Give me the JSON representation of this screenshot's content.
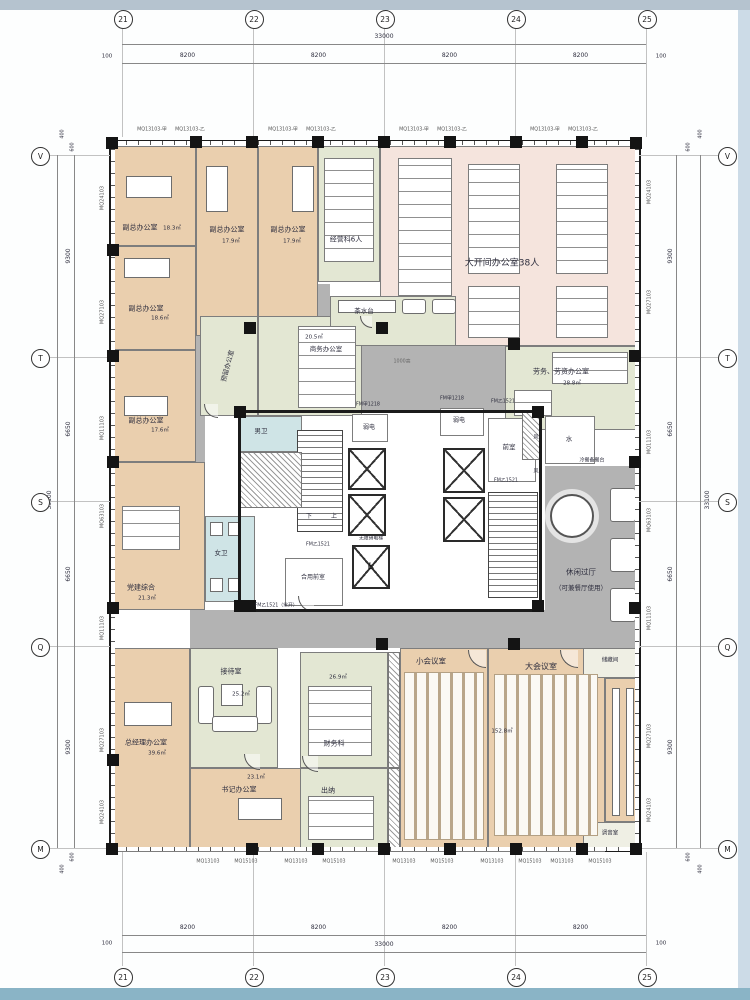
{
  "drawing": {
    "grid": {
      "cols": [
        "21",
        "22",
        "23",
        "24",
        "25"
      ],
      "rows": [
        "V",
        "T",
        "S",
        "Q",
        "M"
      ],
      "bay_width": "8200",
      "total_width": "33000",
      "edge_h": "100",
      "row_dims": [
        "9300",
        "6650",
        "6650",
        "9300"
      ],
      "total_height": "33100",
      "edge_top": [
        "400",
        "600"
      ]
    },
    "curtain_walls": {
      "side": [
        "MQ24103",
        "MQ27103",
        "MQ11103",
        "MQ63103",
        "MQ11103",
        "MQ27103",
        "MQ24103"
      ],
      "top_a": "MQ13103-甲",
      "top_b": "MQ13103-乙",
      "bottom_a": "MQ13103",
      "bottom_b": "MQ15103"
    },
    "rooms": {
      "vice1": {
        "label": "副总办公室",
        "area": "18.3㎡"
      },
      "vice2": {
        "label": "副总办公室",
        "area": "17.9㎡"
      },
      "vice3": {
        "label": "副总办公室",
        "area": "17.9㎡"
      },
      "jingyingke": {
        "label": "经营科6人"
      },
      "openoffice": {
        "label": "大开间办公室38人"
      },
      "laowu": {
        "label": "劳务、劳资办公室",
        "area": "28.8㎡"
      },
      "vice4": {
        "label": "副总办公室",
        "area": "18.6㎡"
      },
      "vice5": {
        "label": "副总办公室",
        "area": "17.6㎡"
      },
      "dangjian": {
        "label": "党建综合",
        "area": "21.3㎡"
      },
      "yuliu": {
        "label": "预留办公室"
      },
      "shangwu": {
        "label": "商务办公室",
        "area": "20.5㎡"
      },
      "zongjingli": {
        "label": "总经理办公室",
        "area": "39.6㎡"
      },
      "jiedai": {
        "label": "接待室",
        "area": "25.2㎡"
      },
      "shuji": {
        "label": "书记办公室",
        "area": "23.1㎡"
      },
      "caiwu": {
        "label": "财务科",
        "area": "26.9㎡"
      },
      "chuna": {
        "label": "出纳"
      },
      "xiaohui": {
        "label": "小会议室"
      },
      "dahui": {
        "label": "大会议室",
        "area": "152.8㎡"
      },
      "chucang": {
        "label": "储藏间"
      },
      "tiaoyin": {
        "label": "调音室"
      }
    },
    "ann": {
      "chashuitai": "茶水台",
      "nanwei": "男卫",
      "nvwei": "女卫",
      "shui": "水",
      "feng": "风",
      "qianshi": "前室",
      "ruodian": "弱电",
      "heyong": "合用前室",
      "wuzhangai": "无障碍电梯",
      "lengcan": "冷餐备餐台",
      "fm_jia": "FM甲1218",
      "fm_yi": "FM乙1521",
      "fm_yi_open": "FM乙1521（常开）",
      "up": "上",
      "down": "下",
      "h1000": "1000高",
      "xiuxian1": "休闲过厅",
      "xiuxian2": "（可兼餐厅使用）"
    },
    "icons": {
      "wheelchair": "♿"
    },
    "colors": {
      "tan": "#eacfae",
      "green": "#e3e7d3",
      "pink": "#f5e4dd",
      "blue": "#cfe4e6",
      "gray": "#b3b3b3",
      "cream": "#efefe4",
      "white": "#ffffff",
      "wall": "#1b1b1b",
      "strip_top": "#b5c3cf",
      "strip_bottom": "#8ab4c6",
      "strip_right": "#ccdbe7"
    }
  }
}
